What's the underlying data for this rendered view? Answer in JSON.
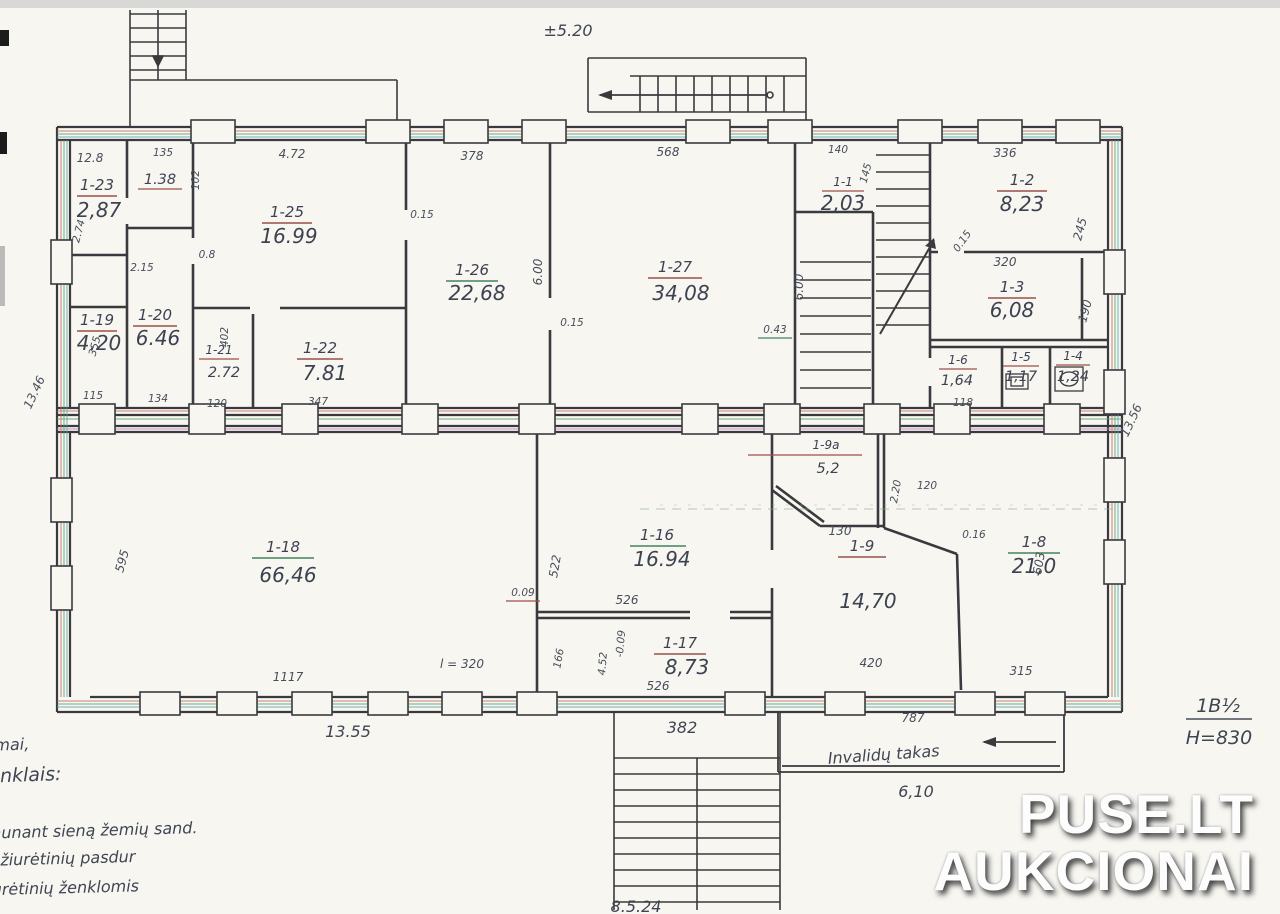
{
  "plan": {
    "type": "building-floor-plan",
    "colors": {
      "ink": "#3a3a3e",
      "pencil_text": "#3c4250",
      "underline_red": "#9c4f48",
      "underline_green": "#44845c",
      "artifact_red": "#c46a62",
      "artifact_green": "#55a06b",
      "artifact_cyan": "#58a7ac"
    }
  },
  "rooms": [
    {
      "label": "1-1",
      "area": "2,03"
    },
    {
      "label": "1-2",
      "area": "8,23"
    },
    {
      "label": "1-3",
      "area": "6,08"
    },
    {
      "label": "1-4",
      "area": "1,24"
    },
    {
      "label": "1-5",
      "area": "1,17"
    },
    {
      "label": "1-6",
      "area": "1,64"
    },
    {
      "label": "1-8",
      "area": "21,0"
    },
    {
      "label": "1-9",
      "area": "14,70"
    },
    {
      "label": "1-9a",
      "area": "5,2"
    },
    {
      "label": "1-16",
      "area": "16.94"
    },
    {
      "label": "1-17",
      "area": "8,73"
    },
    {
      "label": "1-18",
      "area": "66,46"
    },
    {
      "label": "1-19",
      "area": "4.20"
    },
    {
      "label": "1-20",
      "area": "6.46"
    },
    {
      "label": "1-21",
      "area": "2.72"
    },
    {
      "label": "1-22",
      "area": "7.81"
    },
    {
      "label": "1-23",
      "area": "2,87"
    },
    {
      "label": "",
      "area": "1.38"
    },
    {
      "label": "1-25",
      "area": "16.99"
    },
    {
      "label": "1-26",
      "area": "22,68"
    },
    {
      "label": "1-27",
      "area": "34,08"
    }
  ],
  "dims": [
    "12.8",
    "135",
    "102",
    "4.72",
    "378",
    "568",
    "140",
    "145",
    "336",
    "245",
    "0.15",
    "320",
    "190",
    "0.15",
    "6.00",
    "0.15",
    "6.00",
    "0.43",
    "2.15",
    "0.8",
    "2.74",
    "355",
    "115",
    "134",
    "402",
    "120",
    "347",
    "13.46",
    "13.56",
    "118",
    "595",
    "1117",
    "13.55",
    "l = 320",
    "522",
    "0.09",
    "526",
    "166",
    "4.52",
    "-0.09",
    "526",
    "382",
    "130",
    "2.20",
    "120",
    "0.16",
    "603",
    "315",
    "420",
    "787",
    "±5.20",
    "6,10",
    "8.5.24"
  ],
  "notes": {
    "l1": "mai,",
    "l2": "iai ženklais:",
    "l3": "1 ir 1-22 sujungti išpjaunant sieną žemių sand.",
    "l4": "pažiurėtinių pasdur",
    "l5": "9 a pažiurėtinių ženklomis",
    "ramp": "Invalidų takas"
  },
  "title_block": {
    "code": "1B½",
    "height": "H=830"
  },
  "watermark": {
    "line1": "PUSE.LT",
    "line2": "AUKCIONAI"
  }
}
